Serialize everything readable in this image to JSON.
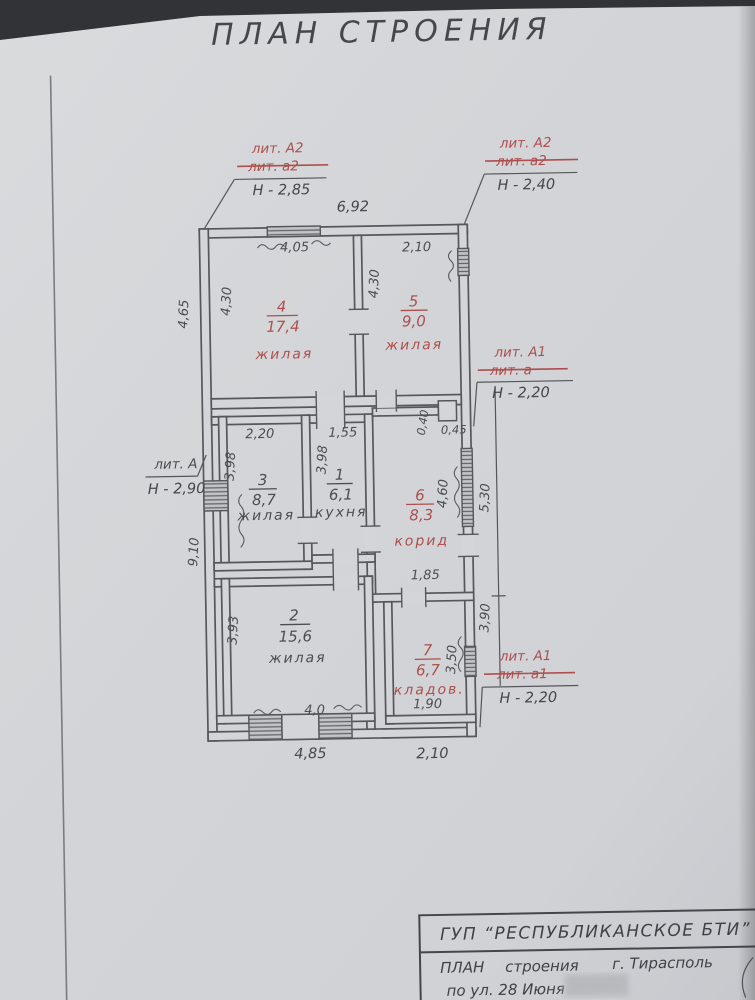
{
  "colors": {
    "ink": "#4c4d51",
    "red": "#ad4f4c",
    "paper": "#d3d5d8"
  },
  "page_title": "ПЛАН  СТРОЕНИЯ",
  "plan": {
    "annotations": {
      "top_left": {
        "lit_new": "лит. А2",
        "lit_old": "лит. а2",
        "height": "Н - 2,85"
      },
      "top_right": {
        "lit_new": "лит. А2",
        "lit_old": "лит. а2",
        "height": "Н - 2,40"
      },
      "left": {
        "lit": "лит. А",
        "height": "Н - 2,90"
      },
      "right_mid": {
        "lit_new": "лит. А1",
        "lit_old": "лит. а",
        "height": "Н - 2,20"
      },
      "right_bot": {
        "lit_new": "лит. А1",
        "lit_old": "лит. а1",
        "height": "Н - 2,20"
      }
    },
    "rooms": {
      "r4": {
        "num": "4",
        "area": "17,4",
        "label": "жилая"
      },
      "r5": {
        "num": "5",
        "area": "9,0",
        "label": "жилая"
      },
      "r3": {
        "num": "3",
        "area": "8,7",
        "label": "жилая"
      },
      "r1": {
        "num": "1",
        "area": "6,1",
        "label": "кухня"
      },
      "r6": {
        "num": "6",
        "area": "8,3",
        "label": "корид"
      },
      "r2": {
        "num": "2",
        "area": "15,6",
        "label": "жилая"
      },
      "r7": {
        "num": "7",
        "area": "6,7",
        "label": "кладов."
      }
    },
    "dims": {
      "top_width": "6,92",
      "r4_top": "4,05",
      "r5_top": "2,10",
      "r4_left": "4,30",
      "r5_left": "4,30",
      "left_upper": "4,65",
      "r3_top": "2,20",
      "k_top": "1,55",
      "r3_left": "3,98",
      "k_left": "3,98",
      "notch_v": "0,40",
      "notch_h": "0,45",
      "corr_right": "4,60",
      "right_upper": "5,30",
      "left_lower": "9,10",
      "corr_bottom": "1,85",
      "right_lower": "3,90",
      "r2_left": "3,93",
      "r7_right": "3,50",
      "r2_bottom": "4,0",
      "r7_bottom": "1,90",
      "bottom_left": "4,85",
      "bottom_right": "2,10"
    }
  },
  "title_block": {
    "org": "ГУП  “РЕСПУБЛИКАНСКОЕ  БТИ”",
    "doc_type": "ПЛАН",
    "doc_object": "строения",
    "city": "г. Тирасполь",
    "address": "по ул.  28 Июня"
  }
}
